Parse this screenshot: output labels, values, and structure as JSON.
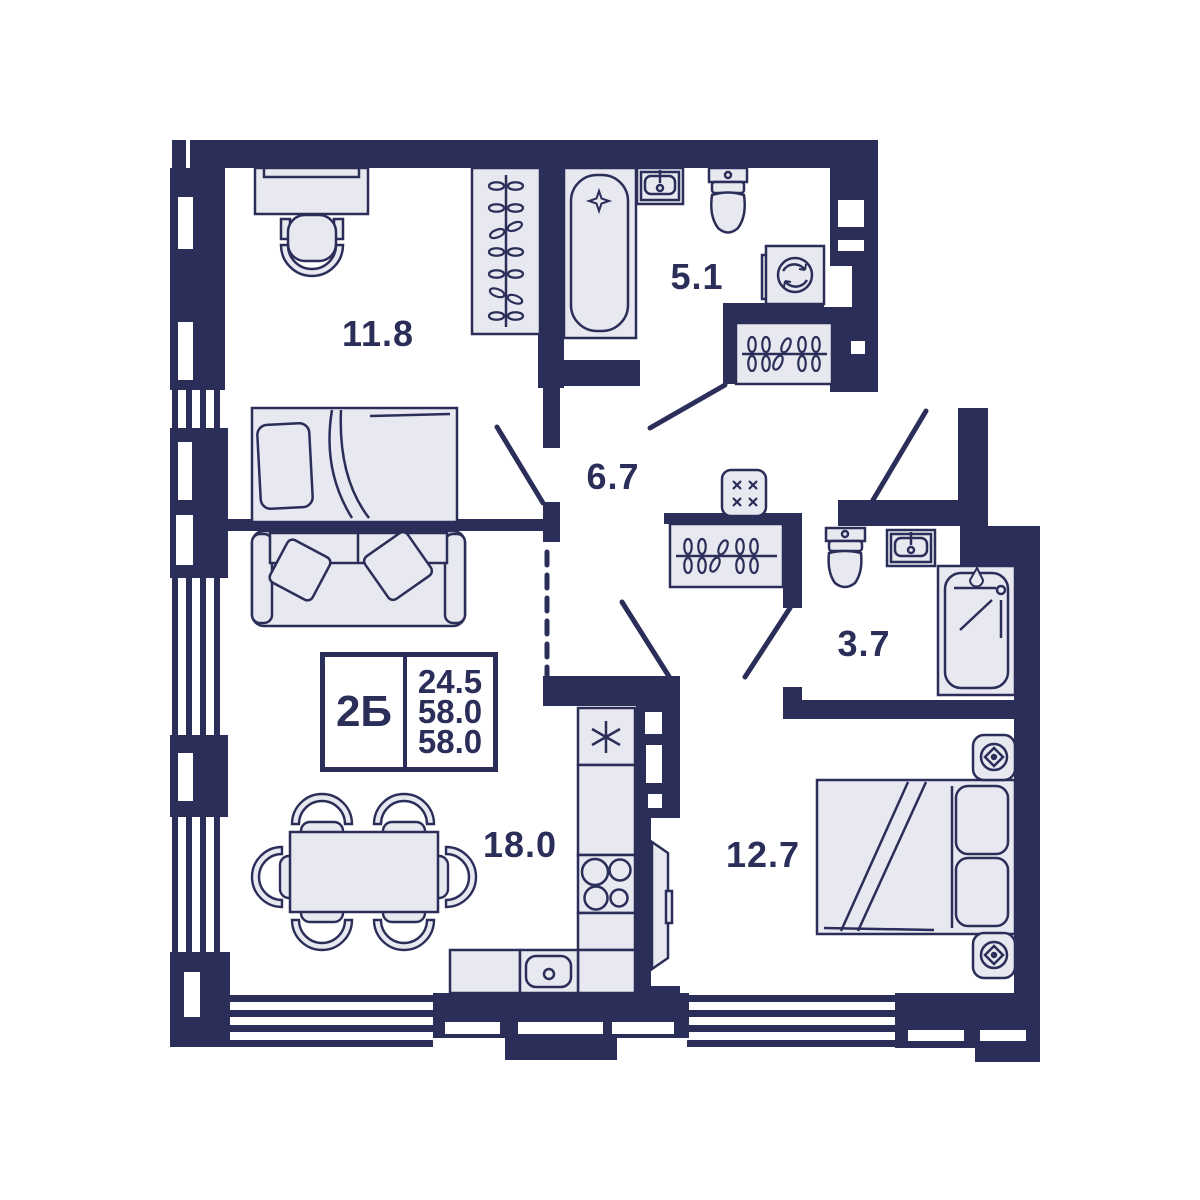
{
  "floor_plan": {
    "info_box": {
      "unit_type": "2Б",
      "area_values": [
        "24.5",
        "58.0",
        "58.0"
      ]
    },
    "rooms": [
      {
        "id": "bedroom-upper",
        "area_label": "11.8"
      },
      {
        "id": "bathroom-main",
        "area_label": "5.1"
      },
      {
        "id": "hallway",
        "area_label": "6.7"
      },
      {
        "id": "bathroom-guest",
        "area_label": "3.7"
      },
      {
        "id": "living-kitchen",
        "area_label": "18.0"
      },
      {
        "id": "bedroom-lower",
        "area_label": "12.7"
      }
    ],
    "furniture_icons": [
      "desk",
      "office-chair",
      "wardrobe-hangers",
      "bed-double",
      "sofa",
      "dining-table-six-chairs",
      "bathtub",
      "sink",
      "toilet",
      "washing-machine",
      "closet-hangers",
      "electrical-panel",
      "fridge",
      "stove-four-burners",
      "kitchen-sink",
      "shower-cabin",
      "tv-panel",
      "nightstand-lamp"
    ],
    "colors": {
      "wall": "#2a2e58",
      "furniture_fill": "#e7e8f0",
      "background": "#ffffff"
    }
  }
}
